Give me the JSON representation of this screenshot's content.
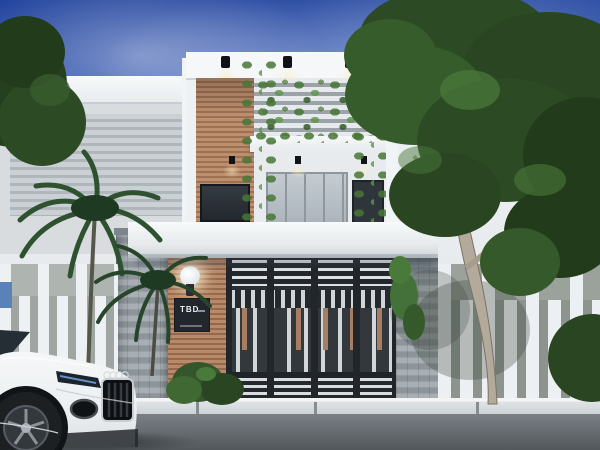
{
  "scene": {
    "type": "architectural-exterior-render",
    "subject": "Modern two-storey house with wood-slat accents, plant-covered louvers, dark metal slatted gate, stone pillars, white picket fences, palm trees, a large shade tree and a white sports car parked on the street"
  },
  "sign": {
    "title": "TBD"
  },
  "colors": {
    "sky_top": "#21439d",
    "sky_horizon": "#ccd7ec",
    "wall_white": "#f2f4f6",
    "wall_shadow": "#d8dcdf",
    "wood": "#b08566",
    "wood_dark": "#95684b",
    "stone": "#9aa2a7",
    "stone_dark": "#565e66",
    "gate_frame": "#2b3034",
    "gate_slat_light": "#d9dde0",
    "gate_wood_slat": "#a57e64",
    "foliage_dark": "#24401f",
    "foliage": "#35552c",
    "vine_green": "#4d7c3a",
    "trunk": "#b4aa9b",
    "fence_white": "#eef1f3",
    "curb": "#dfe3e6",
    "road": "#53585d",
    "car_body": "#f3f5f6",
    "car_detail": "#14171a",
    "lamp_glow": "#fff4d6",
    "sign_bg": "#22262d",
    "sign_text": "#eef1f4"
  }
}
